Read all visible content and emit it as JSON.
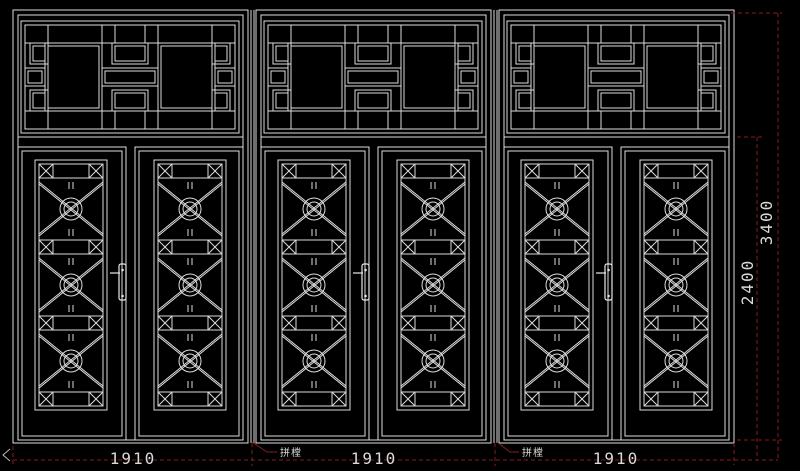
{
  "drawing": {
    "background_color": "#000000",
    "line_color": "#dcdcdc",
    "dimension_color": "#8a1c1c",
    "text_color": "#d9d9d9",
    "units": [
      {
        "id": "door-unit-1",
        "width_label": "1910"
      },
      {
        "id": "door-unit-2",
        "width_label": "1910"
      },
      {
        "id": "door-unit-3",
        "width_label": "1910"
      }
    ],
    "height_dimensions": [
      {
        "label": "2400"
      },
      {
        "label": "3400"
      }
    ],
    "mullion_annotations": [
      {
        "text": "拼樘"
      },
      {
        "text": "拼樘"
      }
    ]
  }
}
